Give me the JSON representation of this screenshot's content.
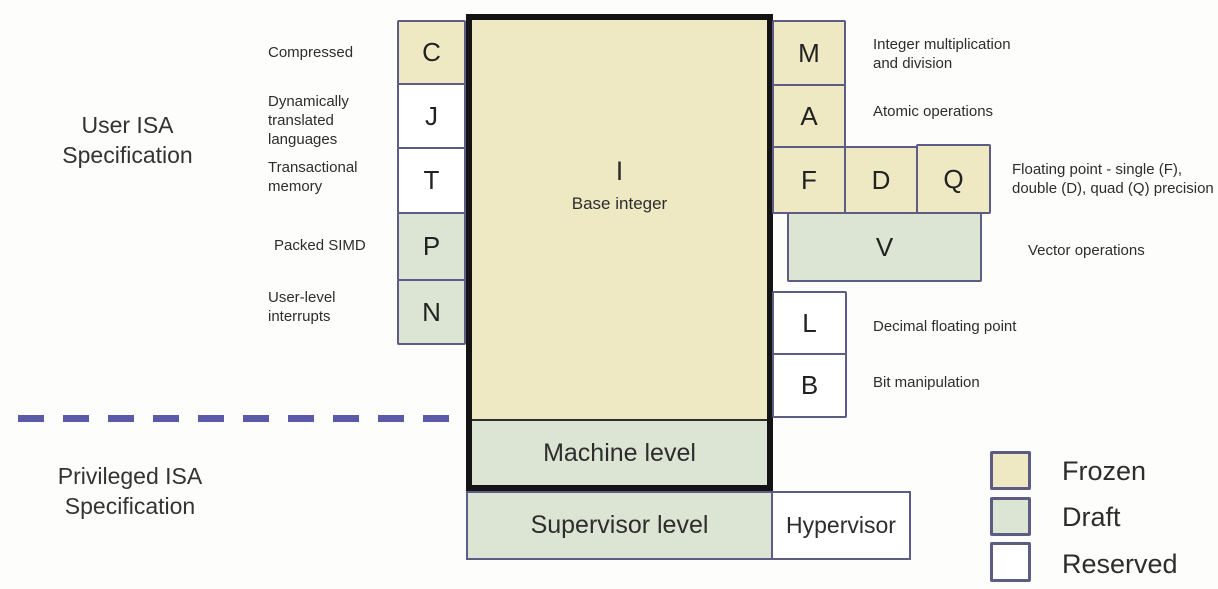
{
  "title_sections": {
    "user": "User ISA Specification",
    "privileged": "Privileged ISA Specification"
  },
  "core": {
    "letter": "I",
    "label": "Base integer",
    "status": "frozen"
  },
  "left_extensions": {
    "c": {
      "letter": "C",
      "status": "frozen",
      "label": "Compressed"
    },
    "j": {
      "letter": "J",
      "status": "reserved",
      "label": "Dynamically translated languages"
    },
    "t": {
      "letter": "T",
      "status": "reserved",
      "label": "Transactional memory"
    },
    "p": {
      "letter": "P",
      "status": "draft",
      "label": "Packed SIMD"
    },
    "n": {
      "letter": "N",
      "status": "draft",
      "label": "User-level interrupts"
    }
  },
  "right_extensions": {
    "m": {
      "letter": "M",
      "status": "frozen",
      "label": "Integer multiplication and division"
    },
    "a": {
      "letter": "A",
      "status": "frozen",
      "label": "Atomic operations"
    },
    "f": {
      "letter": "F",
      "status": "frozen"
    },
    "d": {
      "letter": "D",
      "status": "frozen"
    },
    "q": {
      "letter": "Q",
      "status": "frozen"
    },
    "fdq_label": "Floating point - single (F), double (D), quad (Q) precision",
    "v": {
      "letter": "V",
      "status": "draft",
      "label": "Vector operations"
    },
    "l": {
      "letter": "L",
      "status": "reserved",
      "label": "Decimal floating point"
    },
    "b": {
      "letter": "B",
      "status": "reserved",
      "label": "Bit manipulation"
    }
  },
  "privilege_levels": {
    "machine": {
      "label": "Machine level",
      "status": "draft"
    },
    "supervisor": {
      "label": "Supervisor level",
      "status": "draft"
    },
    "hypervisor": {
      "label": "Hypervisor",
      "status": "reserved"
    }
  },
  "legend": {
    "items": [
      {
        "label": "Frozen",
        "status": "frozen"
      },
      {
        "label": "Draft",
        "status": "draft"
      },
      {
        "label": "Reserved",
        "status": "reserved"
      }
    ]
  },
  "colors": {
    "frozen": "#efe9c3",
    "draft": "#dce5d3",
    "reserved": "#ffffff",
    "box_border": "#5c5c84",
    "thick_border": "#141414",
    "dashed_line": "#5a5aa8",
    "text": "#2d2d2d"
  }
}
